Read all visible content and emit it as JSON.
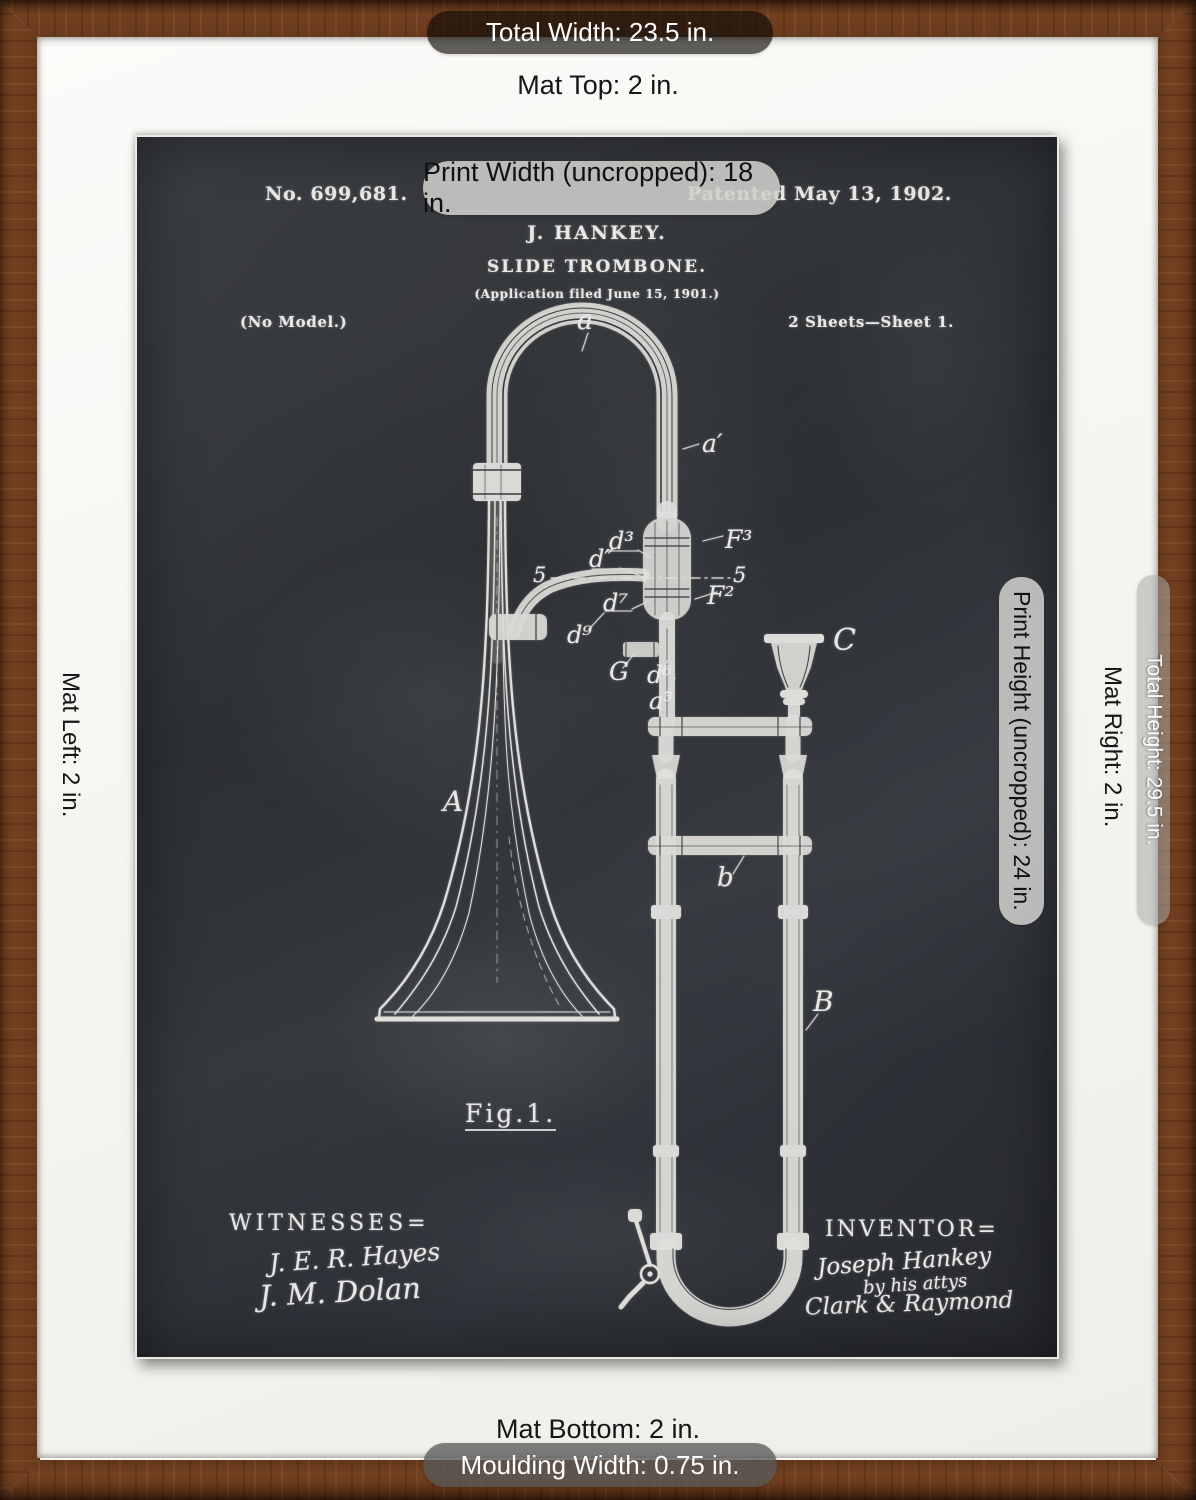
{
  "colors": {
    "frame": "#6f3d1d",
    "mat": "#f8f7f4",
    "board": "#2e3134",
    "chalk": "#e9e8e4"
  },
  "annotations": {
    "total_width": "Total Width: 23.5 in.",
    "mat_top": "Mat Top: 2 in.",
    "print_width": "Print Width (uncropped): 18 in.",
    "print_height": "Print Height (uncropped): 24 in.",
    "mat_right": "Mat Right: 2 in.",
    "total_height": "Total Height: 29.5 in.",
    "mat_left": "Mat Left: 2 in.",
    "mat_bottom": "Mat Bottom: 2 in.",
    "moulding_width": "Moulding Width: 0.75 in."
  },
  "patent": {
    "header": {
      "number": "No. 699,681.",
      "date": "Patented May 13, 1902.",
      "name": "J. HANKEY.",
      "title": "SLIDE TROMBONE.",
      "application": "(Application filed June 15, 1901.)",
      "model": "(No Model.)",
      "sheets": "2 Sheets—Sheet 1."
    },
    "figure": {
      "fig_no": "Fig.1.",
      "labels": {
        "a": "a",
        "a_prime": "a′",
        "d3": "d³",
        "d_dbl": "d″",
        "five_left": "5",
        "five_right": "5",
        "f3": "F³",
        "f2": "F²",
        "d7": "d⁷",
        "d9": "d⁹",
        "g": "G",
        "d6": "d⁶",
        "a3": "a³",
        "c": "C",
        "bell": "A",
        "b_small": "b",
        "b_big": "B"
      }
    },
    "witnesses": {
      "heading": "WITNESSES=",
      "signature1": "J. E. R. Hayes",
      "signature2": "J. M. Dolan"
    },
    "inventor": {
      "heading": "INVENTOR=",
      "name": "Joseph Hankey",
      "by_line": "by his attys",
      "attorneys": "Clark & Raymond"
    }
  }
}
